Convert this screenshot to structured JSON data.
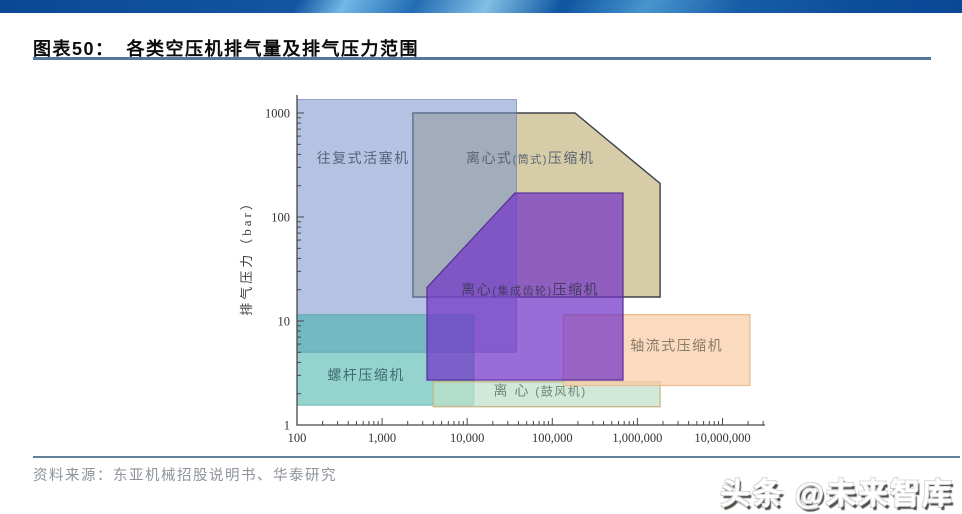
{
  "banner": {
    "base_color": "#0d4e9d",
    "highlight_color": "#58aadc"
  },
  "header": {
    "figure_label": "图表50：",
    "figure_title": "各类空压机排气量及排气压力范围",
    "underline_color": "#54799f"
  },
  "chart_data": {
    "type": "area",
    "title": "各类空压机排气量及排气压力范围",
    "xlabel": "",
    "ylabel": "排气压力（bar）",
    "x_scale": "log",
    "y_scale": "log",
    "xlim": [
      100,
      31600000
    ],
    "ylim": [
      1,
      1490
    ],
    "grid": false,
    "x_ticks": [
      {
        "value": 100,
        "label": "100"
      },
      {
        "value": 1000,
        "label": "1,000"
      },
      {
        "value": 10000,
        "label": "10,000"
      },
      {
        "value": 100000,
        "label": "100,000"
      },
      {
        "value": 1000000,
        "label": "1,000,000"
      },
      {
        "value": 10000000,
        "label": "10,000,000"
      }
    ],
    "y_ticks": [
      {
        "value": 1,
        "label": "1"
      },
      {
        "value": 10,
        "label": "10"
      },
      {
        "value": 100,
        "label": "100"
      },
      {
        "value": 1000,
        "label": "1000"
      }
    ],
    "regions": [
      {
        "name": "centrifugal-barrel-compressor",
        "label_pre": "离心式",
        "label_small": "(筒式)",
        "label_post": "压缩机",
        "label_color": "#5c6472",
        "label_size": 14,
        "small_size": 11,
        "label_at": [
          55000,
          330
        ],
        "shape": "polygon",
        "points": [
          [
            2300,
            1000
          ],
          [
            185000,
            1000
          ],
          [
            1850000,
            210
          ],
          [
            1850000,
            17
          ],
          [
            2300,
            17
          ]
        ],
        "fill": "rgba(187,172,110,0.6)",
        "stroke": "#3f4347",
        "stroke_width": 1.4
      },
      {
        "name": "reciprocating-piston-compressor",
        "label_pre": "往复式活塞机",
        "label_color": "#58627a",
        "label_size": 14,
        "label_at": [
          600,
          330
        ],
        "shape": "rect",
        "x": [
          100,
          38000
        ],
        "y": [
          5,
          1350
        ],
        "fill": "rgba(120,146,202,0.55)",
        "stroke": "rgba(95,120,180,0.6)",
        "stroke_width": 1
      },
      {
        "name": "screw-compressor",
        "label_pre": "螺杆压缩机",
        "label_color": "#3e6a70",
        "label_size": 14,
        "label_at": [
          650,
          2.7
        ],
        "shape": "rect",
        "x": [
          100,
          12000
        ],
        "y": [
          1.55,
          11.5
        ],
        "fill": "rgba(62,176,165,0.55)",
        "stroke": "rgba(45,140,148,0.5)",
        "stroke_width": 1
      },
      {
        "name": "centrifugal-blower",
        "label_pre": "离 心 ",
        "label_small": "(鼓风机)",
        "label_color": "#6d8878",
        "label_size": 14,
        "small_size": 12,
        "label_at": [
          72000,
          1.93
        ],
        "shape": "rect",
        "x": [
          4000,
          1850000
        ],
        "y": [
          1.5,
          2.6
        ],
        "fill": "rgba(190,225,201,0.72)",
        "stroke": "#c8b88b",
        "stroke_width": 1.3
      },
      {
        "name": "axial-flow-compressor",
        "label_pre": "轴流式压缩机",
        "label_color": "#8a7a68",
        "label_size": 14,
        "label_at": [
          2900000,
          5.2
        ],
        "shape": "rect",
        "x": [
          135000,
          21000000
        ],
        "y": [
          2.4,
          11.5
        ],
        "fill": "rgba(248,205,166,0.72)",
        "stroke": "#e9bd92",
        "stroke_width": 1.3
      },
      {
        "name": "centrifugal-geared-compressor",
        "label_pre": "离心",
        "label_small": "(集成齿轮)",
        "label_post": "压缩机",
        "label_color": "#443a63",
        "label_size": 14,
        "small_size": 11,
        "label_at": [
          55000,
          18
        ],
        "shape": "polygon",
        "points": [
          [
            3370,
            21
          ],
          [
            36400,
            170
          ],
          [
            677000,
            170
          ],
          [
            677000,
            2.7
          ],
          [
            3370,
            2.7
          ]
        ],
        "fill": "rgba(115,51,200,0.72)",
        "stroke": "rgba(80,46,148,0.9)",
        "stroke_width": 1.3
      }
    ]
  },
  "source": {
    "text": "资料来源：东亚机械招股说明书、华泰研究"
  },
  "watermark": {
    "text": "头条 @未来智库"
  }
}
